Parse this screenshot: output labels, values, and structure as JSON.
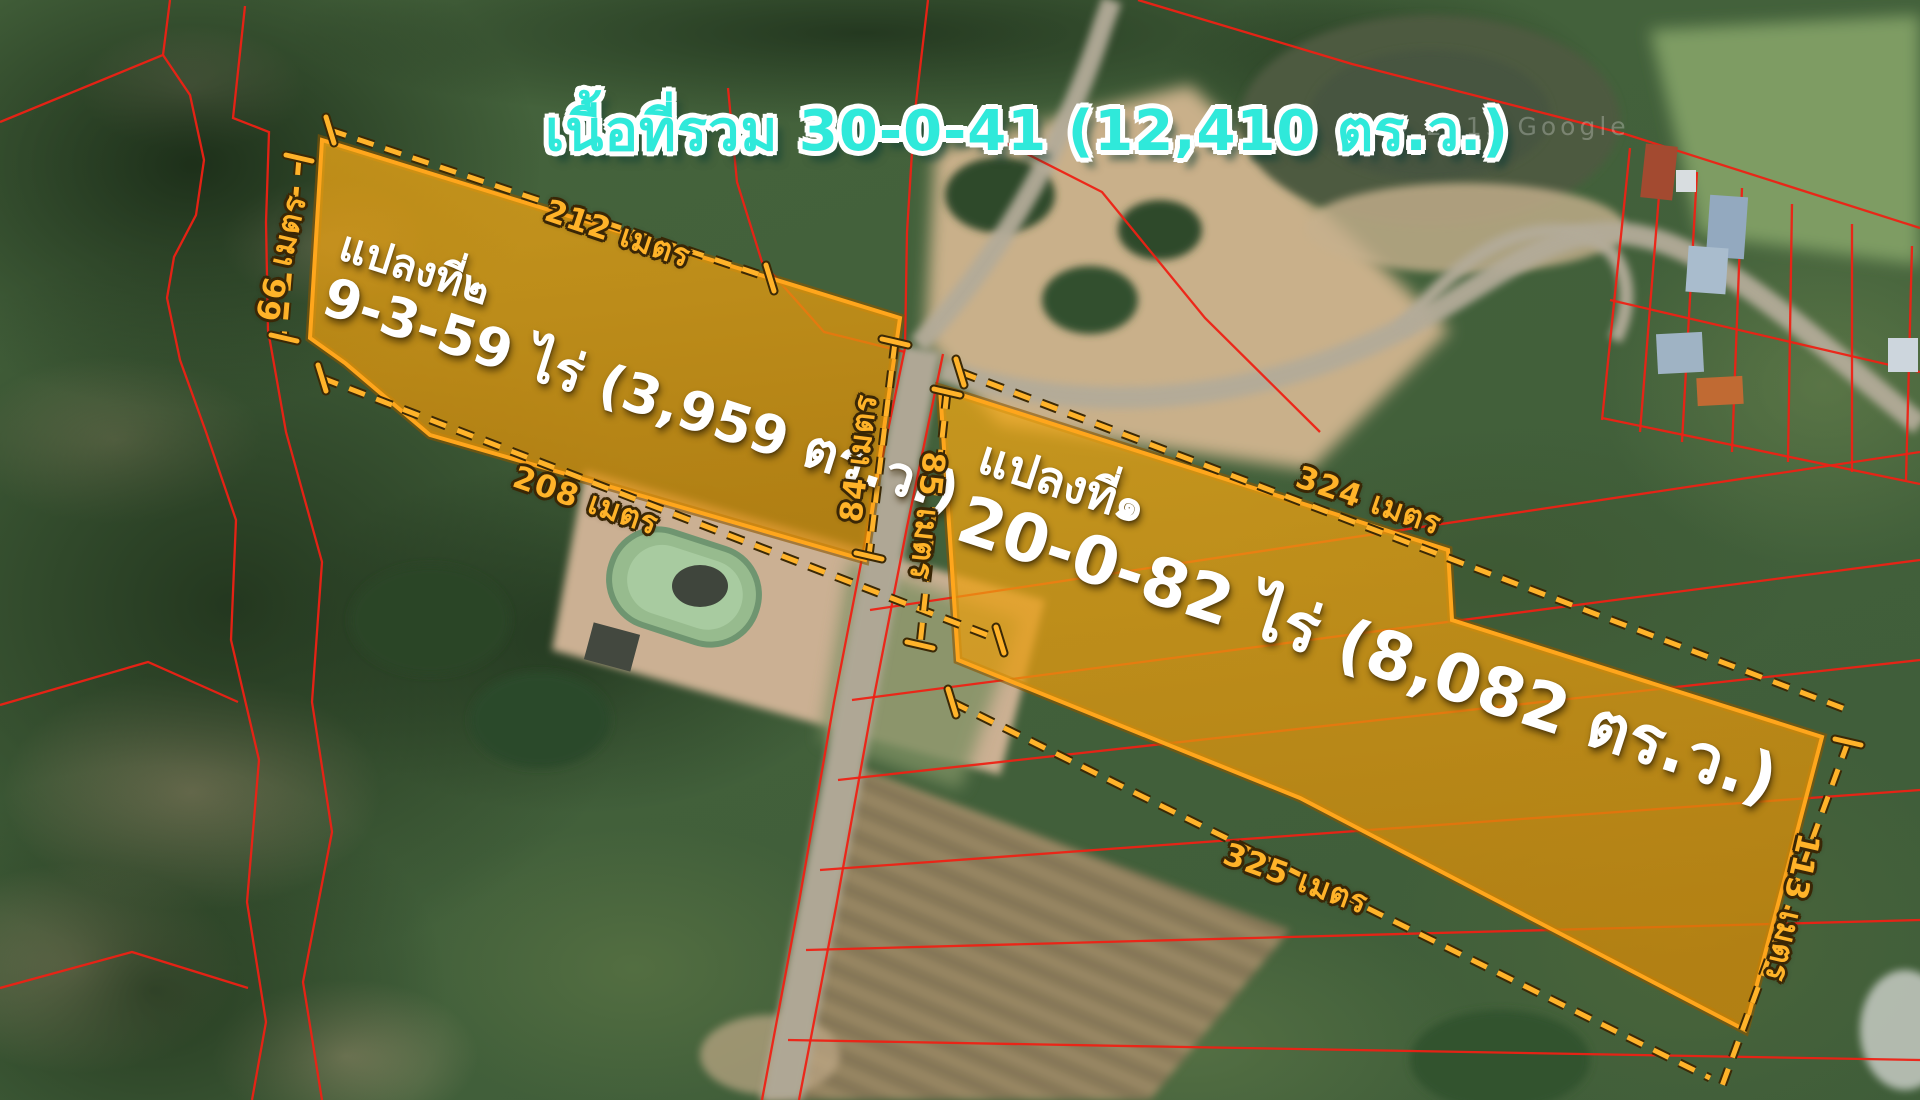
{
  "title": {
    "text": "เนื้อที่รวม 30-0-41 (12,410 ตร.ว.)",
    "color": "#2fe9da"
  },
  "watermark": "© 2013 Google",
  "plots": [
    {
      "id": "plot-2",
      "name_line": "แปลงที่๒",
      "area_line": "9-3-59 ไร่ (3,959 ตร.ว.)"
    },
    {
      "id": "plot-1",
      "name_line": "แปลงที่๑",
      "area_line": "20-0-82 ไร่ (8,082 ตร.ว.)"
    }
  ],
  "dimensions": [
    {
      "id": "plot2-top",
      "label": "212 เมตร"
    },
    {
      "id": "plot2-left",
      "label": "66 เมตร"
    },
    {
      "id": "plot2-bottom",
      "label": "208 เมตร"
    },
    {
      "id": "plot2-right",
      "label": "84 เมตร"
    },
    {
      "id": "plot1-left",
      "label": "85 เมตร"
    },
    {
      "id": "plot1-top",
      "label": "324 เมตร"
    },
    {
      "id": "plot1-bottom",
      "label": "325 เมตร"
    },
    {
      "id": "plot1-right",
      "label": "113 เมตร"
    }
  ],
  "colors": {
    "accent_orange": "#ffb329",
    "plot_fill": "#e89708",
    "plot_border": "#ffa61c",
    "boundary_red": "#ee2114",
    "title_cyan": "#2fe9da",
    "label_white": "#ffffff"
  }
}
